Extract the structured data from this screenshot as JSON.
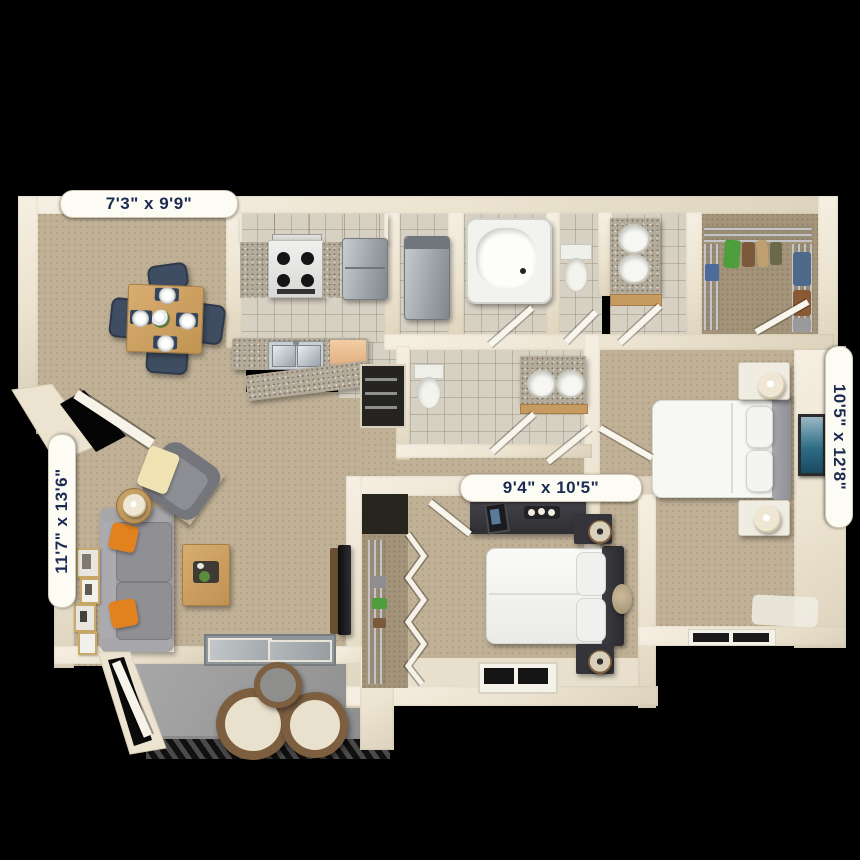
{
  "meta": {
    "title": "3D two-bedroom apartment floor plan"
  },
  "labels": {
    "dining": "7'3\" x 9'9\"",
    "living": "11'7\" x 13'6\"",
    "bedroom2": "9'4\" x 10'5\"",
    "master": "10'5\" x 12'8\""
  },
  "rooms": [
    {
      "id": "dining-room",
      "dims": "7'3\" x 9'9\""
    },
    {
      "id": "living-room",
      "dims": "11'7\" x 13'6\""
    },
    {
      "id": "kitchen"
    },
    {
      "id": "laundry-closet"
    },
    {
      "id": "bathroom"
    },
    {
      "id": "vanity-area"
    },
    {
      "id": "walk-in-closet"
    },
    {
      "id": "master-bathroom"
    },
    {
      "id": "master-bedroom",
      "dims": "10'5\" x 12'8\""
    },
    {
      "id": "bedroom-2",
      "dims": "9'4\" x 10'5\""
    },
    {
      "id": "patio"
    }
  ],
  "colors": {
    "background": "#000000",
    "wall": "#ece3d0",
    "carpet": "#bfb096",
    "tile": "#d7d1c4",
    "kitchen_cabinet": "#eec49c",
    "granite": "#b4aa99",
    "sofa": "#98989d",
    "accent_pillow": "#e2821e",
    "wood": "#cda266",
    "dining_chair": "#3e4d61",
    "patio_floor": "#9b9b9b",
    "label_text": "#1c2b52",
    "artwork": "#2e6e86"
  }
}
